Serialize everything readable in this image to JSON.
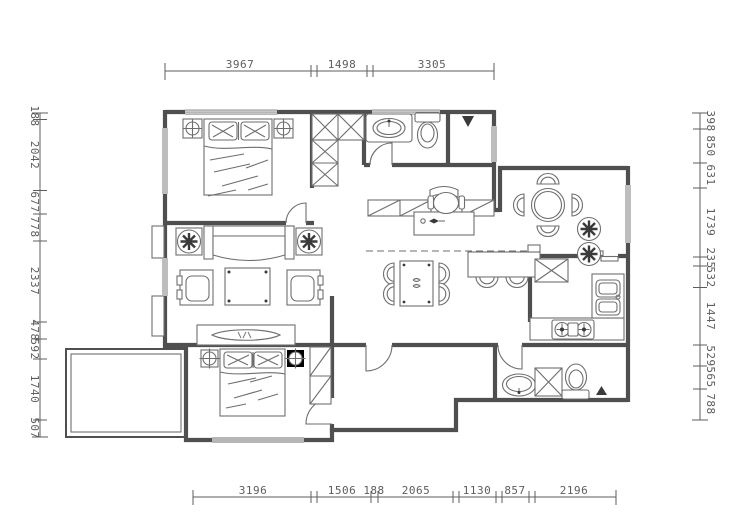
{
  "title": "apartment-floor-plan",
  "colors": {
    "wall": "#4f4f4f",
    "line": "#6e6e6e",
    "dim": "#5d5d5d",
    "dark": "#3a3a3a",
    "bg": "#ffffff"
  },
  "dimensions": {
    "top": [
      "3967",
      "1498",
      "3305"
    ],
    "bottom": [
      "3196",
      "1506",
      "188",
      "2065",
      "1130",
      "857",
      "2196"
    ],
    "left": [
      "188",
      "2042",
      "677",
      "778",
      "2337",
      "478",
      "592",
      "1740",
      "507"
    ],
    "right": [
      "398",
      "850",
      "631",
      "1739",
      "235",
      "532",
      "1447",
      "529",
      "565",
      "788"
    ]
  }
}
